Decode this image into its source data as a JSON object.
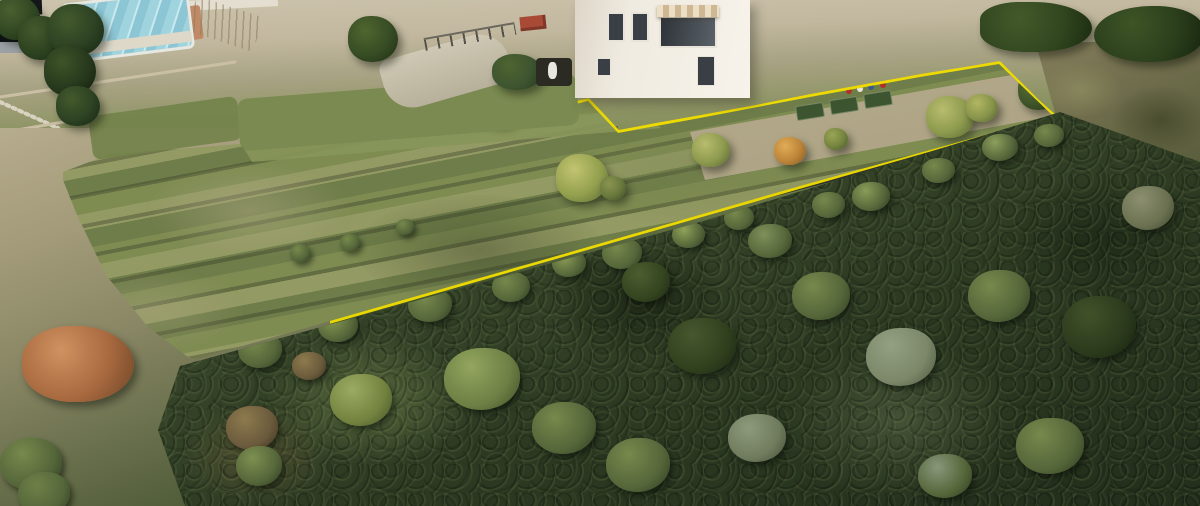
{
  "scene": {
    "type": "aerial-drone-photograph",
    "subject": "terraced hillside building plot outlined in yellow below a white villa, Mediterranean scrubland downhill",
    "figures_visible": 2
  },
  "annotation": {
    "shape": "polygon",
    "purpose": "property-boundary",
    "color": "#f0dc00",
    "stroke_width": "5.5",
    "points": "63,172 80,160 110,154 170,149 240,144 310,139 380,133 450,126 510,117 560,108 580,103 588,101 603,117 618,133 655,126 700,118 755,108 810,97 865,87 920,77 970,69 999,64 1018,83 1036,101 1053,116 1000,129 940,146 870,166 800,186 720,209 640,232 560,255 480,278 400,301 330,321 270,338 225,351 197,359 188,357 170,346 148,327 126,303 106,275 90,246 77,215 68,190 63,180"
  },
  "palette": {
    "boundary_yellow": "#f0dc00",
    "sunlit_ground": "#c6bca4",
    "terrace_grass": "#7d8c53",
    "stone_wall": "#3a3e32",
    "forest_dark": "#2c3a22",
    "pool_cover": "#9fd4de",
    "villa_wall": "#efeae0"
  }
}
